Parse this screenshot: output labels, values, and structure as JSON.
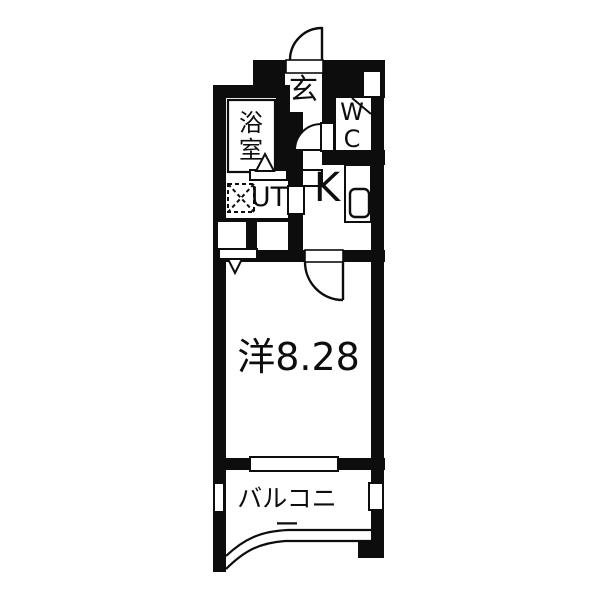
{
  "floor_plan": {
    "rooms": {
      "entrance": {
        "label": "玄"
      },
      "toilet": {
        "label": "WC"
      },
      "bathroom": {
        "label": "浴室"
      },
      "utility": {
        "label": "UT"
      },
      "kitchen": {
        "label": "K"
      },
      "main_room": {
        "label": "洋8.28"
      },
      "balcony": {
        "label": "バルコニー"
      }
    },
    "colors": {
      "wall": "#0d0d0d",
      "background": "#ffffff",
      "line": "#0d0d0d"
    }
  }
}
